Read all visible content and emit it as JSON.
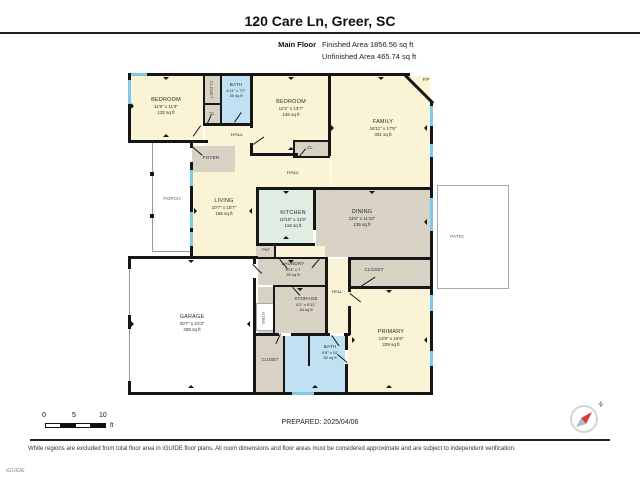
{
  "header": {
    "title": "120 Care Ln, Greer, SC",
    "floor_label": "Main Floor",
    "finished_area": "Finished Area 1856.56 sq ft",
    "unfinished_area": "Unfinished Area 465.74 sq ft"
  },
  "rooms": {
    "bedroom1": {
      "name": "BEDROOM",
      "dims": "11'9\" x 11'3\"",
      "area": "132 sq ft"
    },
    "bedroom2": {
      "name": "BEDROOM",
      "dims": "12'2\" x 13'7\"",
      "area": "148 sq ft"
    },
    "bath1": {
      "name": "BATH",
      "dims": "4'11\" x 7'2\"",
      "area": "35 sq ft"
    },
    "family": {
      "name": "FAMILY",
      "dims": "16'11\" x 17'9\"",
      "area": "301 sq ft"
    },
    "living": {
      "name": "LIVING",
      "dims": "10'7\" x 15'7\"",
      "area": "155 sq ft"
    },
    "kitchen": {
      "name": "KITCHEN",
      "dims": "10'10\" x 11'9\"",
      "area": "118 sq ft"
    },
    "dining": {
      "name": "DINING",
      "dims": "11'5\" x 11'10\"",
      "area": "135 sq ft"
    },
    "laundry": {
      "name": "LAUNDRY",
      "dims": "10'3\" x 7'",
      "area": "53 sq ft"
    },
    "storage": {
      "name": "STORAGE",
      "dims": "8'1\" x 6'11\"",
      "area": "44 sq ft"
    },
    "garage": {
      "name": "GARAGE",
      "dims": "20'7\" x 21'3\"",
      "area": "438 sq ft"
    },
    "primary": {
      "name": "PRIMARY",
      "dims": "13'9\" x 16'9\"",
      "area": "229 sq ft"
    },
    "bath2": {
      "name": "BATH",
      "dims": "9'8\" x 10'",
      "area": "60 sq ft"
    }
  },
  "labels": {
    "porch": "PORCH",
    "patio": "PATIO",
    "foyer": "FOYER",
    "hall": "HALL",
    "closet": "CLOSET",
    "cl": "CL",
    "pnt": "PNT",
    "strg": "STRG",
    "fp": "F/P"
  },
  "footer": {
    "scale": {
      "t0": "0",
      "t5": "5",
      "t10": "10",
      "unit": "ft"
    },
    "prepared": "PREPARED: 2025/04/06",
    "disclaimer": "White regions are excluded from total floor area in iGUIDE floor plans. All room dimensions and floor areas must be considered approximate and are subject to independent verification.",
    "watermark": "iGUIDE",
    "north": "N"
  },
  "colors": {
    "finished_room": "#fbf3d6",
    "closet_area": "#d8d2c4",
    "bathroom": "#bfe1f1",
    "kitchen": "#e0ede2",
    "wall": "#161616",
    "window": "#7ec9e8",
    "unfinished": "#ffffff"
  }
}
